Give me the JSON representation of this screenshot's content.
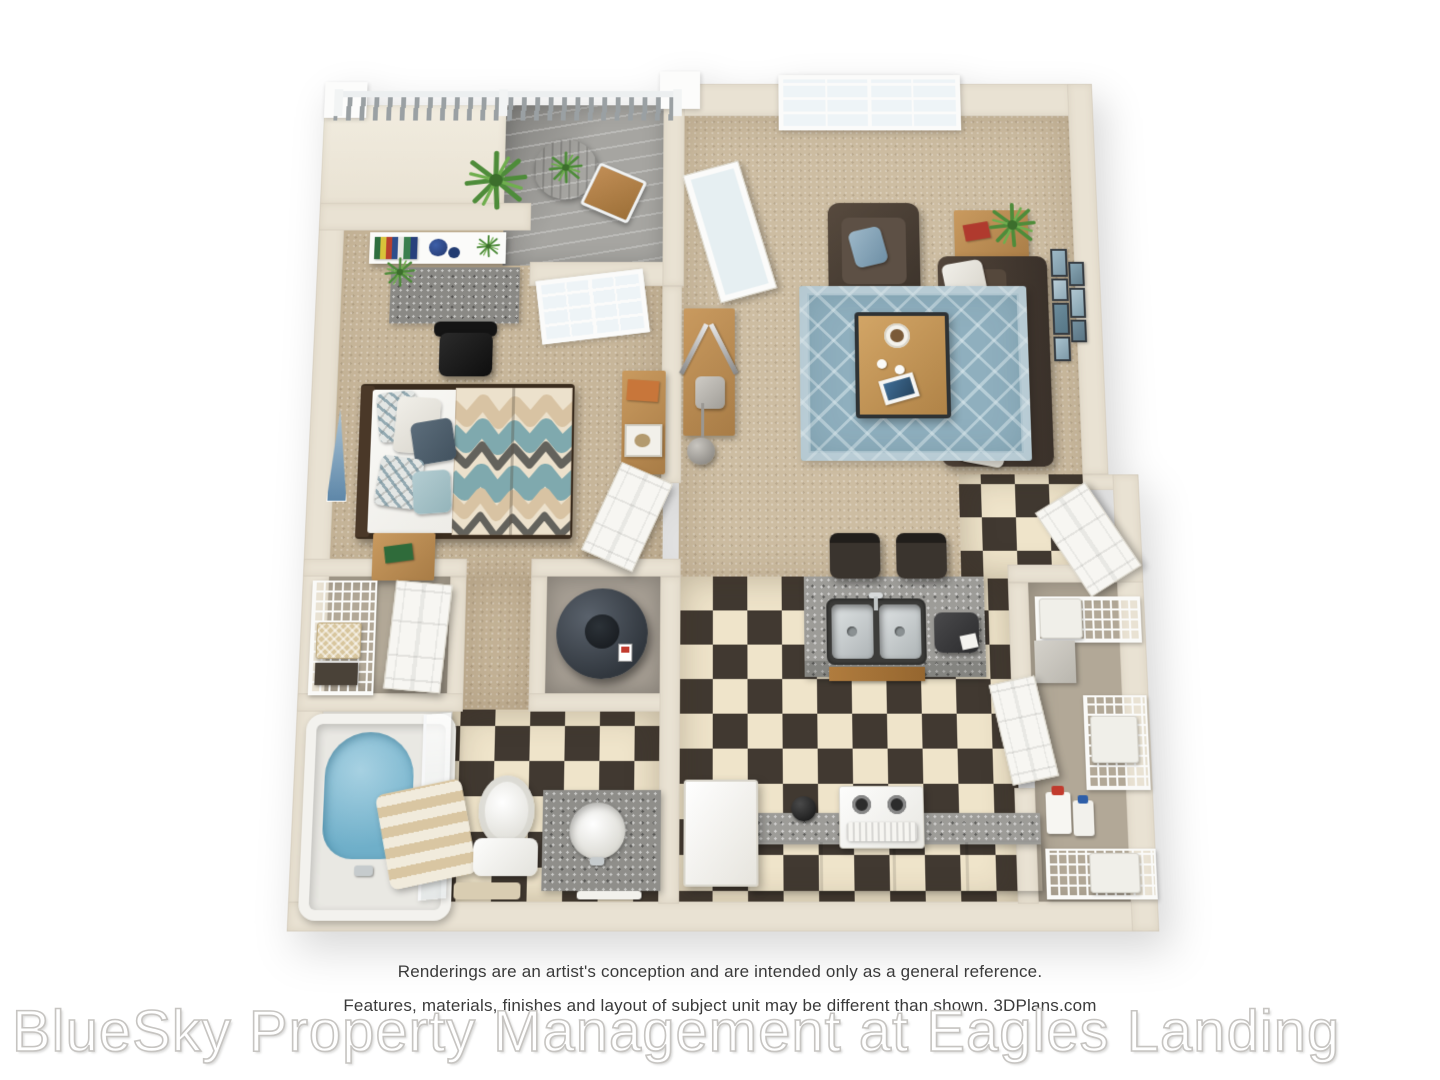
{
  "image_type": "3D rendered one-bedroom apartment floor plan (top-down view)",
  "footer": {
    "disclaimer_line1": "Renderings are an artist's conception and are intended only as a general reference.",
    "disclaimer_line2": "Features, materials, finishes and layout of subject unit may be different than shown. 3DPlans.com",
    "watermark": "BlueSky Property Management at Eagles Landing"
  },
  "scene": {
    "rooms": [
      "balcony",
      "bedroom",
      "living-room",
      "entry",
      "kitchen",
      "pantry-laundry",
      "bedroom-closet",
      "water-heater-closet",
      "bathroom"
    ],
    "furniture": [
      "bistro-table",
      "bistro-chair",
      "potted-plants",
      "wall-shelf-with-books",
      "built-in-desk",
      "office-chair",
      "queen-bed",
      "nightstand",
      "dresser",
      "wall-art-triangle",
      "window",
      "french-door",
      "armchair",
      "sofa",
      "end-table",
      "coffee-table",
      "media-console",
      "floor-lamp",
      "gallery-frames",
      "area-rug",
      "kitchen-island-with-double-sink",
      "barstools",
      "coffee-maker",
      "range",
      "refrigerator",
      "lower-cabinets",
      "kettle",
      "wire-shelving",
      "laundry-baskets",
      "detergent-bottles",
      "water-heater",
      "bathtub",
      "shower-glass",
      "towels",
      "toilet",
      "vanity-sink",
      "bath-mat",
      "front-door",
      "interior-doors"
    ]
  },
  "palette": {
    "wall": "#e9e2d3",
    "wall-edge": "#d8cfbc",
    "carpet": "#c7b69a",
    "carpet2": "#cdbda2",
    "plank": "#a6a5a1",
    "tile-dark": "#413931",
    "tile-light": "#efe4ca",
    "granite": "#9d9c98",
    "granite-dark": "#8a8985",
    "rug": "#8fafbe",
    "sofa": "#4b3f35",
    "sofa-dark": "#3a312a",
    "wood": "#c99a5f",
    "wood-dark": "#a87c46",
    "water": "#85bdd3",
    "closet-floor": "#b2a897",
    "blue-art": "#7fa3c0",
    "plant-green": "#4e8c3a"
  }
}
